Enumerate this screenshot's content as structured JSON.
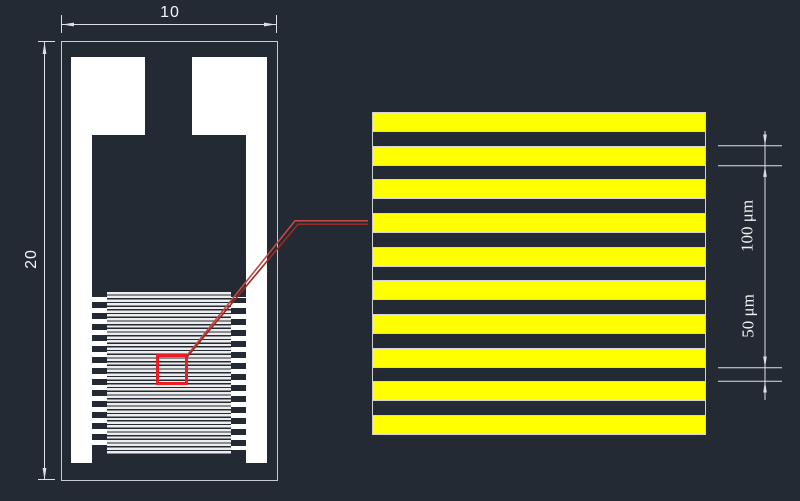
{
  "scene": {
    "background_color": "#242a34",
    "description": "CAD drawing of an interdigitated electrode chip (left) with magnified view of electrode fingers (right)"
  },
  "device_view": {
    "width_dimension_label": "10",
    "height_dimension_label": "20"
  },
  "detail_view": {
    "stripe_count": 10,
    "stripe_color": "#ffff00",
    "finger_width_label": "100 μm",
    "finger_gap_label": "50 μm"
  },
  "colors": {
    "dimension_line": "#dce0e5",
    "white_fill": "#ffffff",
    "device_outline": "#c7ccd3",
    "zoom_box_red": "#ec1c24",
    "leader_red_bright": "#c14b42",
    "leader_red_dark": "#9a2a26"
  }
}
